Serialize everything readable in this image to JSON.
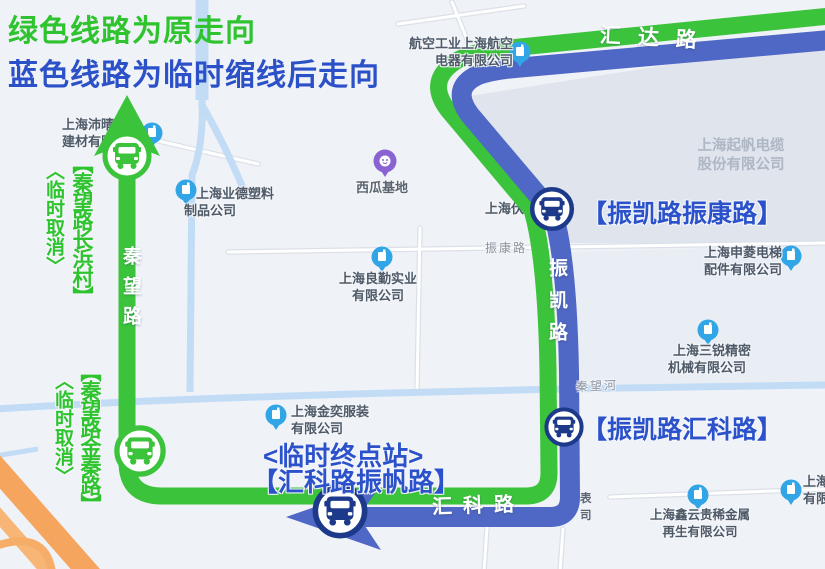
{
  "legend": {
    "line1": "绿色线路为原走向",
    "line2": "蓝色线路为临时缩线后走向"
  },
  "roads": {
    "huida": "汇达路",
    "qinwang": "秦望路",
    "zhenkai": "振凯路",
    "huike": "汇科路",
    "zhenkang": "振康路",
    "river": "秦望河"
  },
  "stops": {
    "changbang_tag": "〈临时取消〉",
    "changbang_name": "【秦望路长浜村】",
    "jinqin_tag": "〈临时取消〉",
    "jinqin_name": "【秦望路金秦路】",
    "zhenkang_name": "【振凯路振康路】",
    "huike_name": "【振凯路汇科路】",
    "terminal_tag": "<临时终点站>",
    "terminal_name": "【汇科路振帆路】"
  },
  "pois": {
    "hangkong": {
      "line1": "航空工业上海航空",
      "line2": "电器有限公司"
    },
    "peiqing": {
      "line1": "上海沛晴",
      "line2": "建材有限"
    },
    "yede": {
      "line1": "上海业德塑料",
      "line2": "制品公司"
    },
    "xigua": {
      "name": "西瓜基地"
    },
    "fujun": {
      "name": "上海伏骏"
    },
    "liangqin": {
      "line1": "上海良勤实业",
      "line2": "有限公司"
    },
    "qifan": {
      "line1": "上海起帆电缆",
      "line2": "股份有限公司"
    },
    "shenling": {
      "line1": "上海申菱电梯",
      "line2": "配件有限公司"
    },
    "sanrui": {
      "line1": "上海三锐精密",
      "line2": "机械有限公司"
    },
    "jinyi": {
      "line1": "上海金奕服装",
      "line2": "有限公司"
    },
    "xinyun": {
      "line1": "上海鑫云贵稀金属",
      "line2": "再生有限公司"
    },
    "edge_right": {
      "line1": "上海",
      "line2": "有限"
    },
    "partial": {
      "line1": "表",
      "line2": "司"
    }
  },
  "colors": {
    "route_green": "#3cc33c",
    "route_blue": "#5068c5",
    "text_green": "#2fc42f",
    "text_blue": "#2b52cb",
    "highway_orange": "#f5a55d",
    "river_blue": "#c3dcf5",
    "pin_blue": "#31a5e6",
    "pin_purple": "#8a63d2",
    "bus_ring_blue": "#1d3a8a"
  }
}
